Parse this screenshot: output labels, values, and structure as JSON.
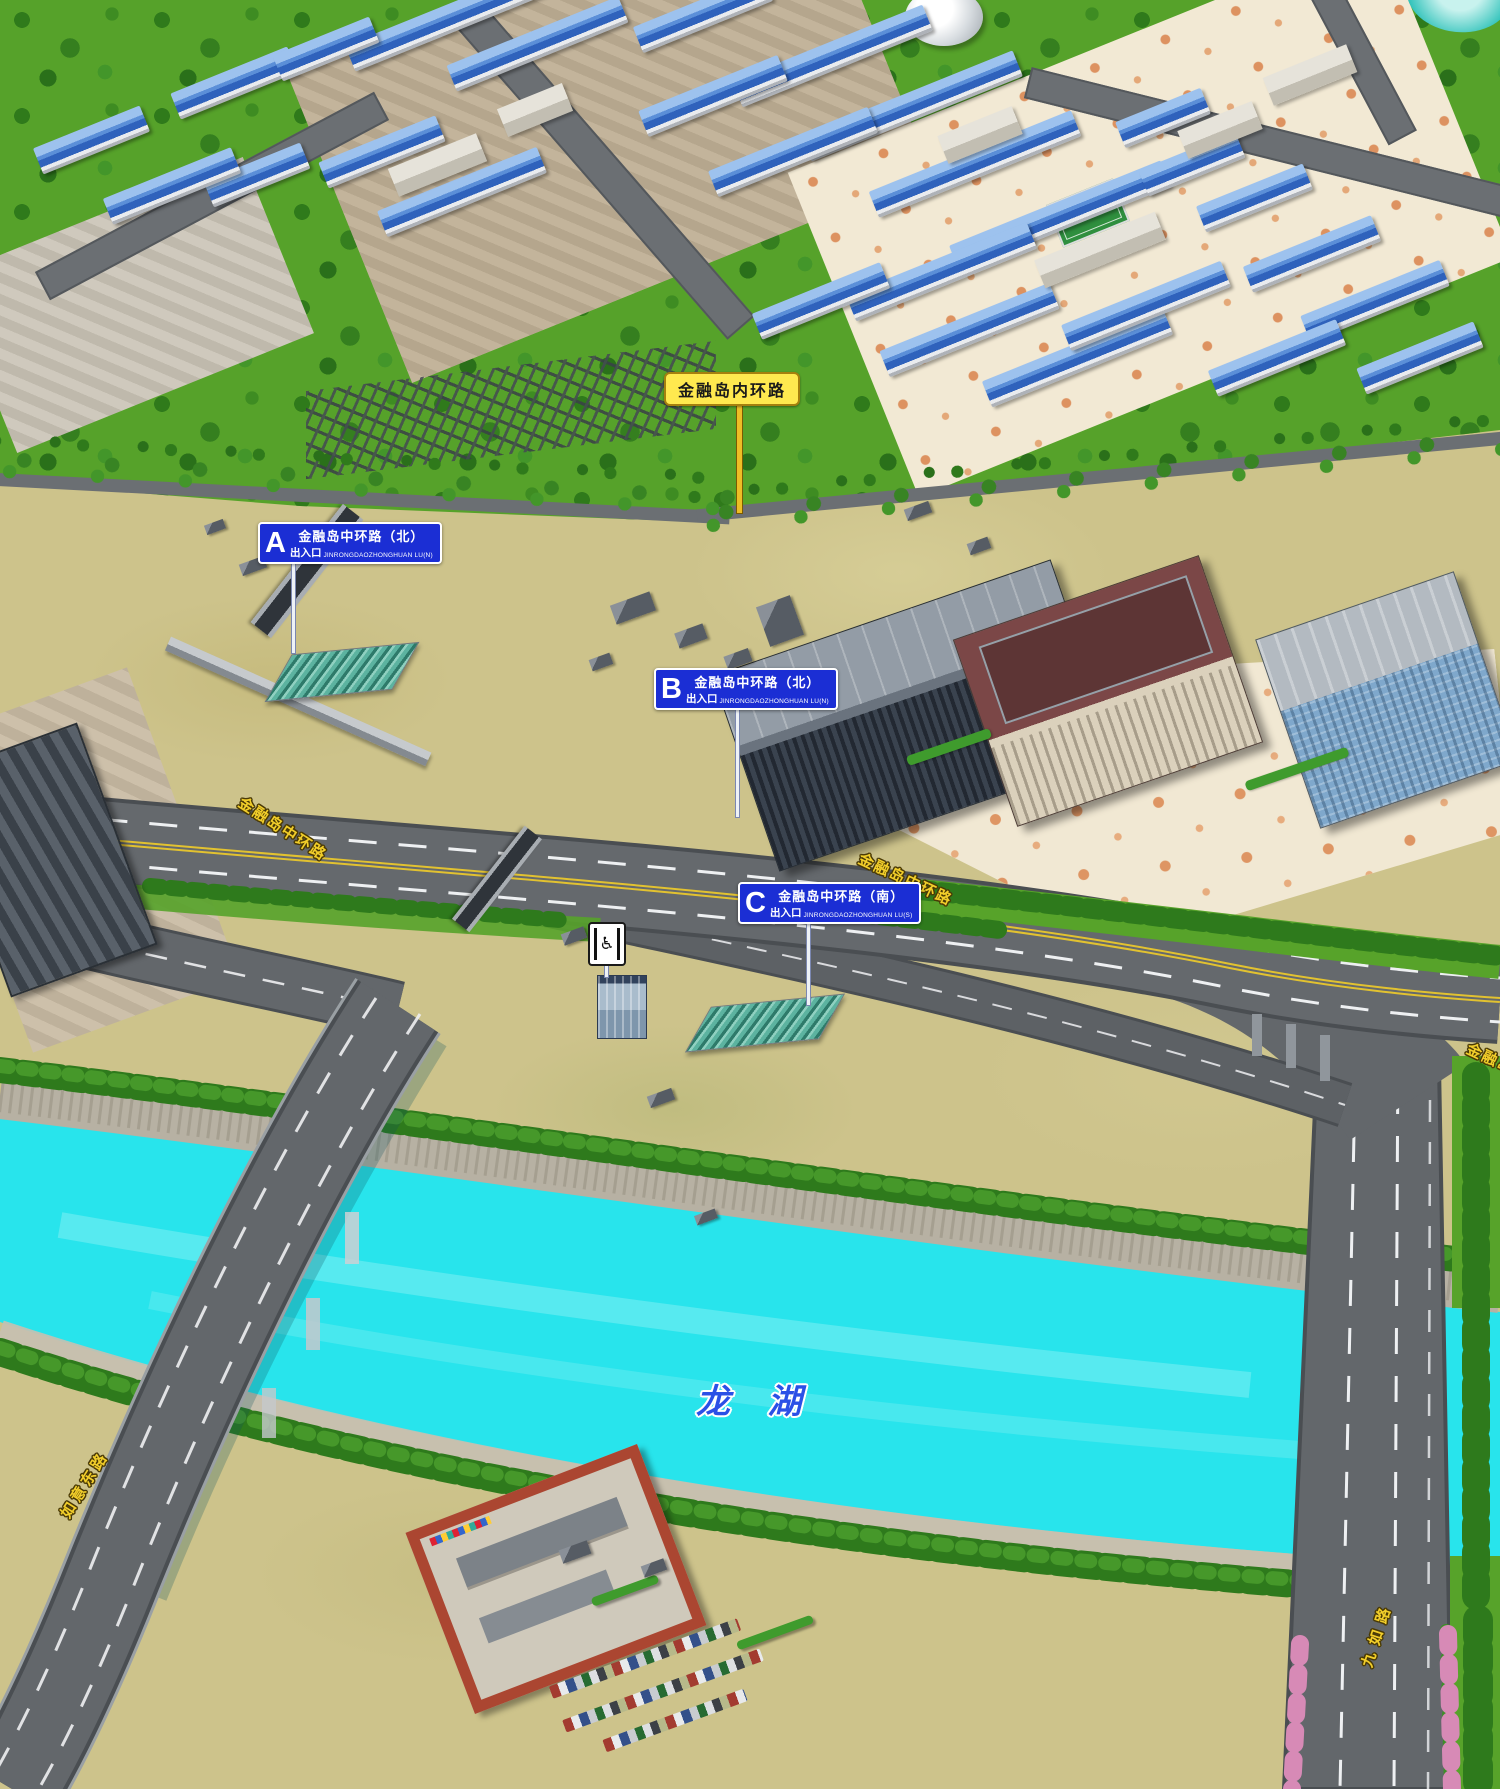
{
  "map": {
    "region_sign": {
      "label": "金融岛内环路"
    },
    "entrances": [
      {
        "letter": "A",
        "suffix": "出入口",
        "road": "金融岛中环路（北）",
        "pinyin": "JINRONGDAOZHONGHUAN LU(N)"
      },
      {
        "letter": "B",
        "suffix": "出入口",
        "road": "金融岛中环路（北）",
        "pinyin": "JINRONGDAOZHONGHUAN LU(N)"
      },
      {
        "letter": "C",
        "suffix": "出入口",
        "road": "金融岛中环路（南）",
        "pinyin": "JINRONGDAOZHONGHUAN LU(S)"
      }
    ],
    "road_labels": {
      "central_west": "金融岛中环路",
      "central_east": "金融岛中环路",
      "central_edge": "金融岛中环路",
      "ruyi_east": "如意东路",
      "jiuru": "九如路"
    },
    "lake": {
      "name": "龙 湖"
    },
    "icons": {
      "accessible_elevator": "♿"
    },
    "colors": {
      "sign_blue": "#1b2ed4",
      "sign_yellow": "#ffe94f",
      "label_yellow": "#f2ce2a",
      "water": "#28e4ec",
      "lake_text": "#2b50e6"
    }
  }
}
